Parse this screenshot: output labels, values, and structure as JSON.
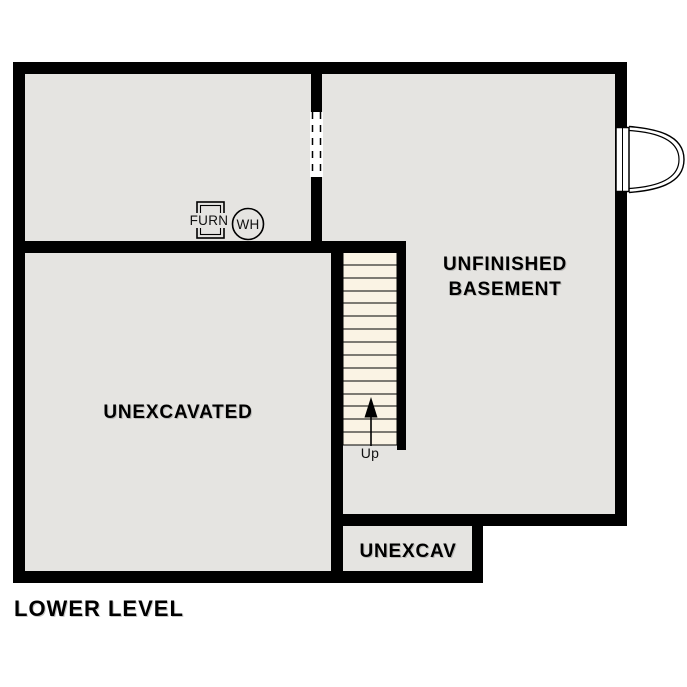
{
  "plan": {
    "title": "LOWER LEVEL",
    "rooms": {
      "basement": {
        "label_line1": "UNFINISHED",
        "label_line2": "BASEMENT"
      },
      "unexcavated": {
        "label": "UNEXCAVATED"
      },
      "unexcav_small": {
        "label": "UNEXCAV"
      }
    },
    "stairs": {
      "label": "Up",
      "tread_count": 15,
      "direction": "up"
    },
    "equipment": {
      "furnace": {
        "label": "FURN"
      },
      "water_heater": {
        "label": "WH"
      }
    },
    "colors": {
      "wall": "#000000",
      "floor": "#e5e4e1",
      "stair_tread": "#faf3e4",
      "background": "#ffffff",
      "text": "#000000"
    }
  }
}
